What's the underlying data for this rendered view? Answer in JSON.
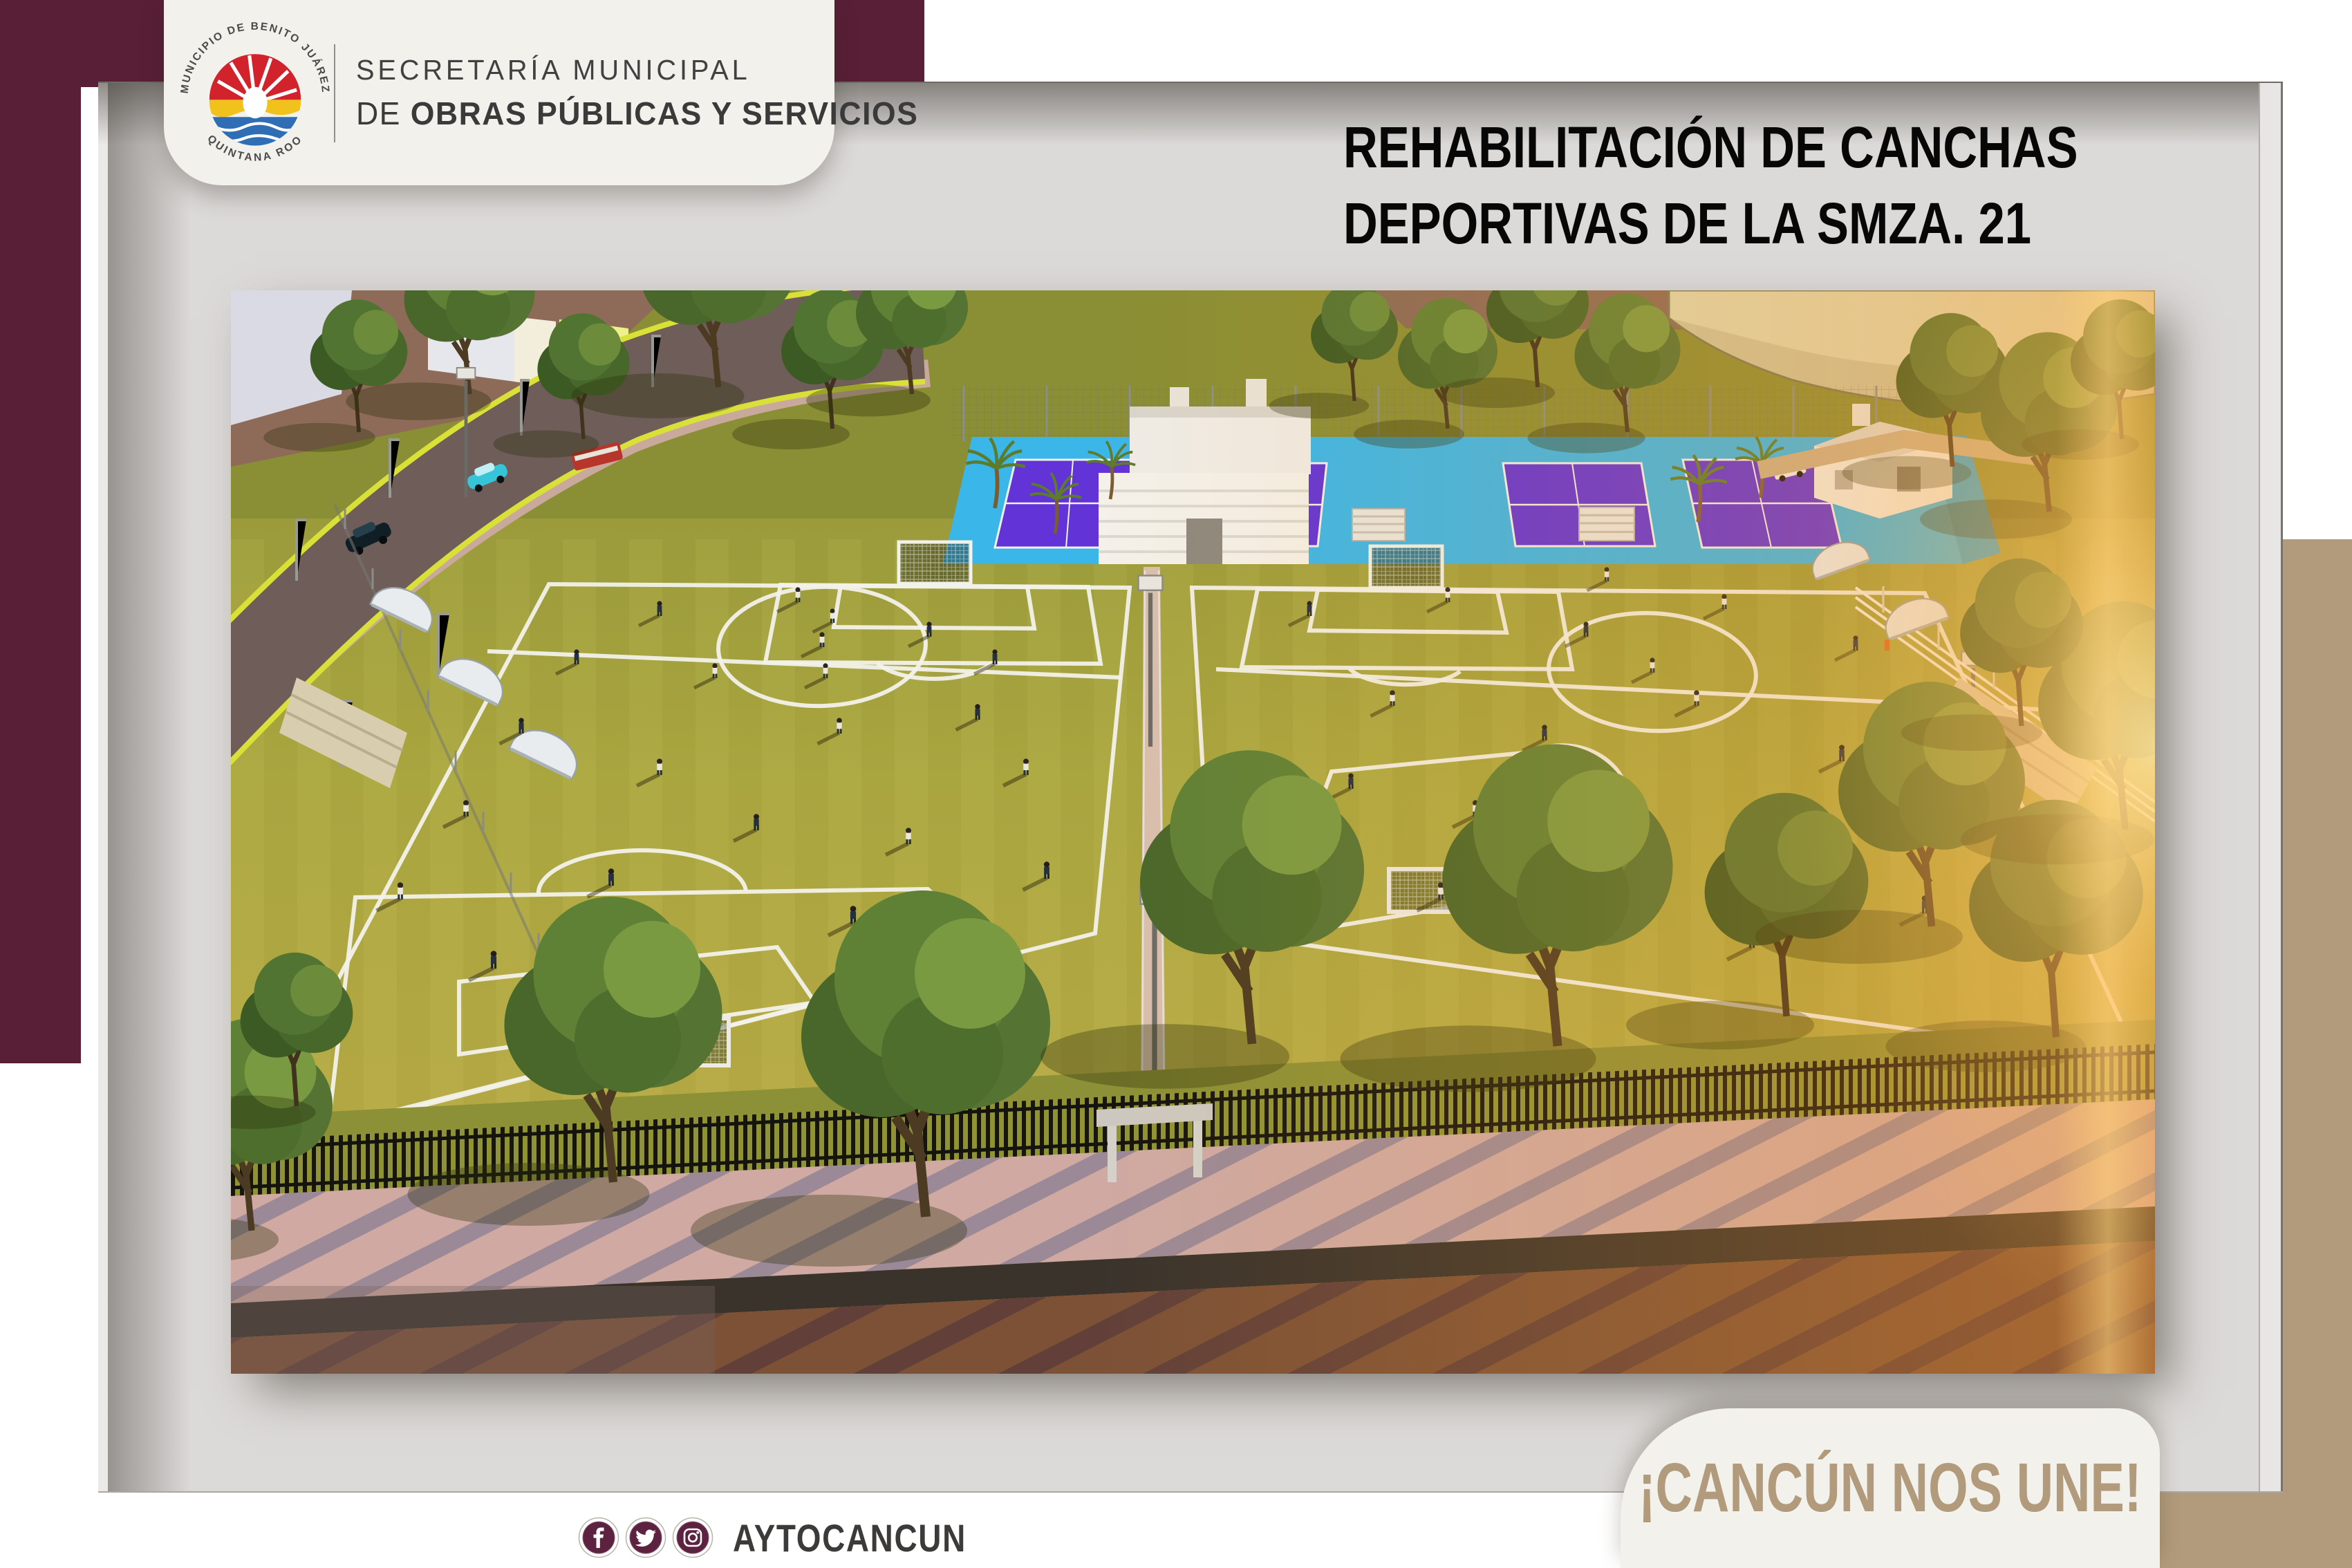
{
  "header_card": {
    "line1": "SECRETARÍA MUNICIPAL",
    "line2_prefix": "DE ",
    "line2_bold": "OBRAS PÚBLICAS Y SERVICIOS",
    "logo": {
      "top_arc": "MUNICIPIO DE BENITO JUÁREZ",
      "bottom_arc": "QUINTANA ROO",
      "colors": {
        "red": "#d2232c",
        "yellow": "#f2c21c",
        "blue": "#2f6db5"
      }
    }
  },
  "title": {
    "line1": "REHABILITACIÓN DE CANCHAS",
    "line2": "DEPORTIVAS DE LA SMZA. 21",
    "color": "#070707"
  },
  "footer": {
    "handle": "AYTOCANCUN",
    "icons": [
      "facebook-icon",
      "twitter-icon",
      "instagram-icon"
    ],
    "icon_bg": "#5d2240"
  },
  "slogan": {
    "text": "¡CANCÚN NOS UNE!",
    "text_color": "#b29b7c"
  },
  "palette": {
    "maroon": "#591f36",
    "tan": "#b29b7c",
    "panel_gray": "#dcdad8",
    "card_cream": "#f3f1ec",
    "canvas_white": "#ffffff"
  },
  "render": {
    "description": "Aerial sunset 3D render of two rehabilitated soccer fields with white markings, central walkway, blue multi-sport court deck with purple tennis courts, kiosk building, trees, perimeter fences, street with cars and sidewalk",
    "colors": {
      "grass": "#a9a43e",
      "court_deck": "#3bb6e9",
      "court_purple": "#6233d6",
      "road": "#6e5d58",
      "sidewalk": "#cfa9a2",
      "sun_glow": "#ffd27a"
    }
  }
}
